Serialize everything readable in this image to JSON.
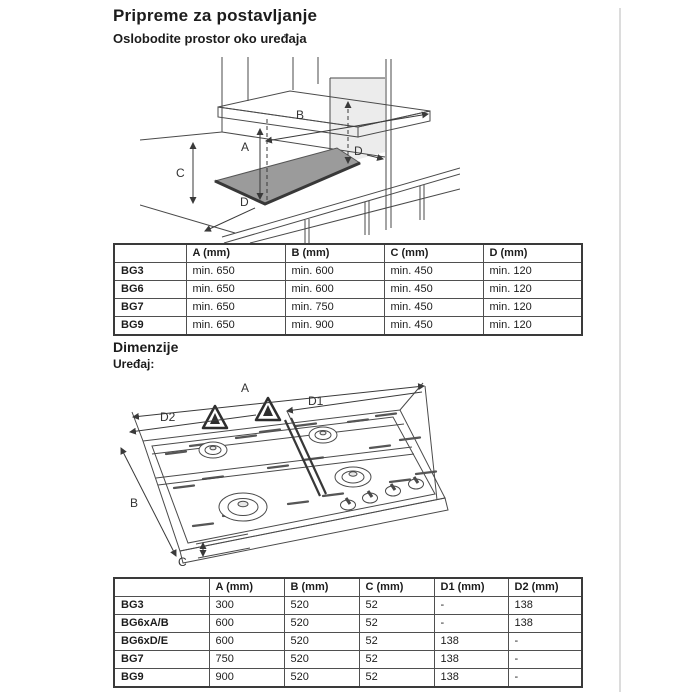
{
  "page": {
    "title": "Pripreme za postavljanje",
    "subtitle": "Oslobodite prostor oko uređaja",
    "dimensions_heading": "Dimenzije",
    "device_label": "Uređaj:"
  },
  "clearance_diagram": {
    "label_a": "A",
    "label_b": "B",
    "label_c": "C",
    "label_d_top": "D",
    "label_d_bottom": "D"
  },
  "clearance_table": {
    "headers": [
      "",
      "A (mm)",
      "B (mm)",
      "C (mm)",
      "D (mm)"
    ],
    "rows": [
      {
        "label": "BG3",
        "values": [
          "min. 650",
          "min. 600",
          "min. 450",
          "min. 120"
        ]
      },
      {
        "label": "BG6",
        "values": [
          "min. 650",
          "min. 600",
          "min. 450",
          "min. 120"
        ]
      },
      {
        "label": "BG7",
        "values": [
          "min. 650",
          "min. 750",
          "min. 450",
          "min. 120"
        ]
      },
      {
        "label": "BG9",
        "values": [
          "min. 650",
          "min. 900",
          "min. 450",
          "min. 120"
        ]
      }
    ]
  },
  "device_diagram": {
    "label_a": "A",
    "label_b": "B",
    "label_c": "C",
    "label_d1": "D1",
    "label_d2": "D2"
  },
  "device_table": {
    "headers": [
      "",
      "A (mm)",
      "B (mm)",
      "C (mm)",
      "D1 (mm)",
      "D2 (mm)"
    ],
    "rows": [
      {
        "label": "BG3",
        "values": [
          "300",
          "520",
          "52",
          "-",
          "138"
        ]
      },
      {
        "label": "BG6xA/B",
        "values": [
          "600",
          "520",
          "52",
          "-",
          "138"
        ]
      },
      {
        "label": "BG6xD/E",
        "values": [
          "600",
          "520",
          "52",
          "138",
          "-"
        ]
      },
      {
        "label": "BG7",
        "values": [
          "750",
          "520",
          "52",
          "138",
          "-"
        ]
      },
      {
        "label": "BG9",
        "values": [
          "900",
          "520",
          "52",
          "138",
          "-"
        ]
      }
    ]
  },
  "colors": {
    "line": "#4a4a4a",
    "hob_fill": "#9b9b9b",
    "cabinet_panel_fill": "#ececec",
    "page_edge": "#dcdcdc"
  }
}
